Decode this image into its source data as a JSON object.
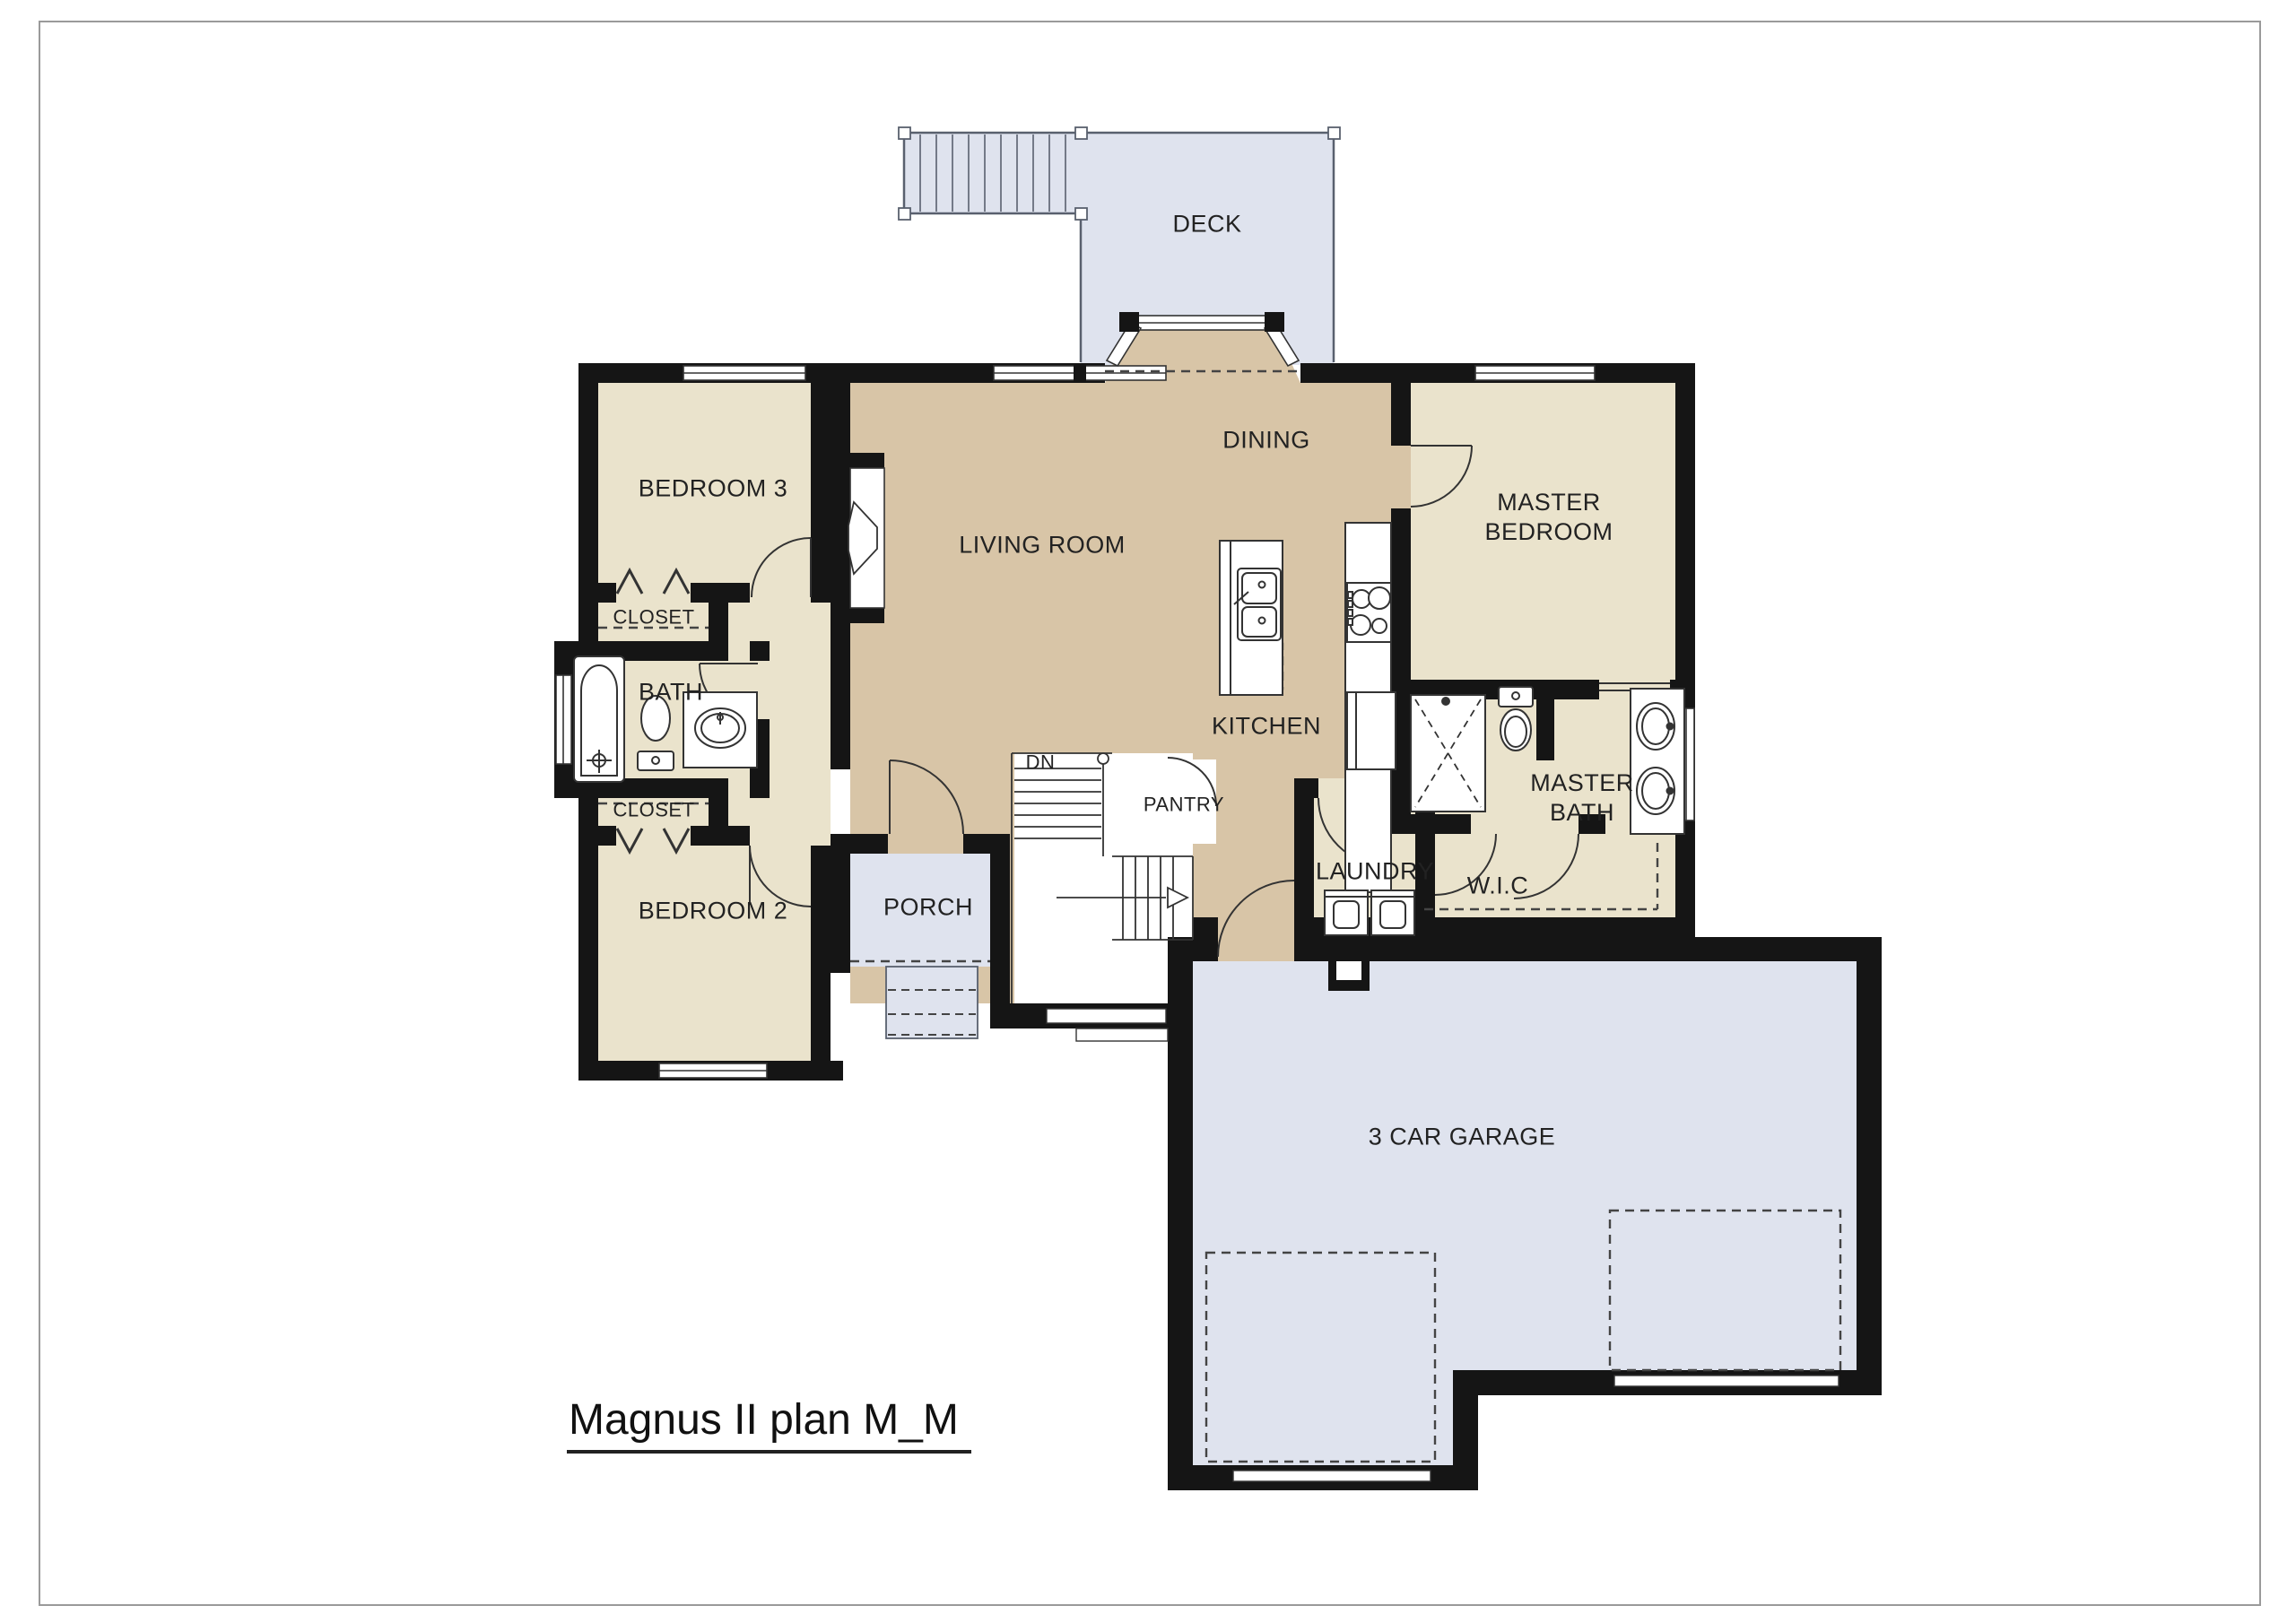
{
  "plan": {
    "title": "Magnus II plan M_M",
    "labels": {
      "deck": "DECK",
      "bedroom3": "BEDROOM 3",
      "closet_top": "CLOSET",
      "bath": "BATH",
      "closet_bottom": "CLOSET",
      "bedroom2": "BEDROOM 2",
      "living": "LIVING ROOM",
      "dining": "DINING",
      "kitchen": "KITCHEN",
      "pantry": "PANTRY",
      "dn": "DN",
      "porch": "PORCH",
      "laundry": "LAUNDRY",
      "master_bedroom": "MASTER\nBEDROOM",
      "master_bath": "MASTER\nBATH",
      "wic": "W.I.C",
      "garage": "3 CAR GARAGE"
    },
    "colors": {
      "room_beige": "#eae3cc",
      "room_tan": "#d8c5a7",
      "outdoor_gray": "#dfe3ee",
      "wall_black": "#151515",
      "line": "#333333"
    }
  }
}
